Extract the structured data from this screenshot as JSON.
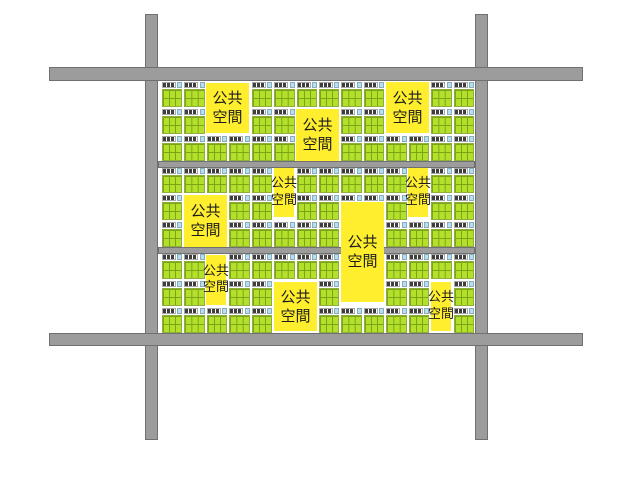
{
  "diagram": {
    "title": "urban-block-plan",
    "label_full": "公共空間",
    "colors": {
      "background": "#ffffff",
      "road": "#9c9c9c",
      "road_border": "#707070",
      "green": "#b4e02c",
      "green_line": "#7aa517",
      "green_border": "#8fae3a",
      "building": "#3e3e3e",
      "building_border": "#a8a8a8",
      "building_divider": "#ffffff",
      "blue": "#b7dff0",
      "blue_border": "#86aebf",
      "public_space": "#ffee2e",
      "label_text": "#1c1c1c"
    },
    "roads": [
      {
        "name": "road-vertical-left",
        "x": 145,
        "y": 14,
        "w": 13,
        "h": 426
      },
      {
        "name": "road-vertical-right",
        "x": 475,
        "y": 14,
        "w": 13,
        "h": 426
      },
      {
        "name": "road-horizontal-top",
        "x": 49,
        "y": 67,
        "w": 534,
        "h": 14
      },
      {
        "name": "road-horizontal-bottom",
        "x": 49,
        "y": 333,
        "w": 534,
        "h": 13
      },
      {
        "name": "road-internal-upper",
        "x": 158,
        "y": 161,
        "w": 317,
        "h": 7
      },
      {
        "name": "road-internal-lower",
        "x": 158,
        "y": 247,
        "w": 317,
        "h": 7
      }
    ],
    "blocks": {
      "x": 162,
      "y": 82,
      "width": 312,
      "height": 251,
      "columns": 14,
      "bands": [
        {
          "name": "band-top",
          "top": 0,
          "rows": [
            "MMEEMMMMMMEEMM",
            "MMEEMMEEMMEEMM",
            "MMMMMMEEMMMMMM"
          ]
        },
        {
          "name": "band-middle",
          "top": 86,
          "rows": [
            "MMMMMEMMMMMEMM",
            "MEEMMEMMBBMEMM",
            "MEEMMMMMEEMMMM"
          ]
        },
        {
          "name": "band-bottom",
          "top": 172,
          "rows": [
            "MMEMMMMMEEMMMM",
            "MMEMMEEMEEMMEM",
            "MMMMMEEMMMMMEM"
          ]
        }
      ]
    },
    "public_spaces": [
      {
        "x": 44,
        "y": 1,
        "w": 43,
        "h": 50,
        "font": 15,
        "lines": [
          "公共",
          "空間"
        ]
      },
      {
        "x": 134,
        "y": 27,
        "w": 43,
        "h": 52,
        "font": 15,
        "lines": [
          "公共",
          "空間"
        ]
      },
      {
        "x": 224,
        "y": 0,
        "w": 43,
        "h": 51,
        "font": 15,
        "lines": [
          "公共",
          "空間"
        ]
      },
      {
        "x": 112,
        "y": 86,
        "w": 20,
        "h": 49,
        "font": 13,
        "lines": [
          "公共",
          "空間"
        ]
      },
      {
        "x": 246,
        "y": 86,
        "w": 20,
        "h": 49,
        "font": 13,
        "lines": [
          "公共",
          "空間"
        ]
      },
      {
        "x": 22,
        "y": 113,
        "w": 43,
        "h": 52,
        "font": 15,
        "lines": [
          "公共",
          "空間"
        ]
      },
      {
        "x": 179,
        "y": 120,
        "w": 43,
        "h": 100,
        "font": 15,
        "lines": [
          "公共",
          "空間"
        ]
      },
      {
        "x": 44,
        "y": 173,
        "w": 20,
        "h": 50,
        "font": 13,
        "lines": [
          "公共",
          "空間"
        ]
      },
      {
        "x": 112,
        "y": 200,
        "w": 43,
        "h": 49,
        "font": 15,
        "lines": [
          "公共",
          "空間"
        ]
      },
      {
        "x": 269,
        "y": 200,
        "w": 20,
        "h": 49,
        "font": 13,
        "lines": [
          "公共",
          "空間"
        ]
      }
    ]
  }
}
